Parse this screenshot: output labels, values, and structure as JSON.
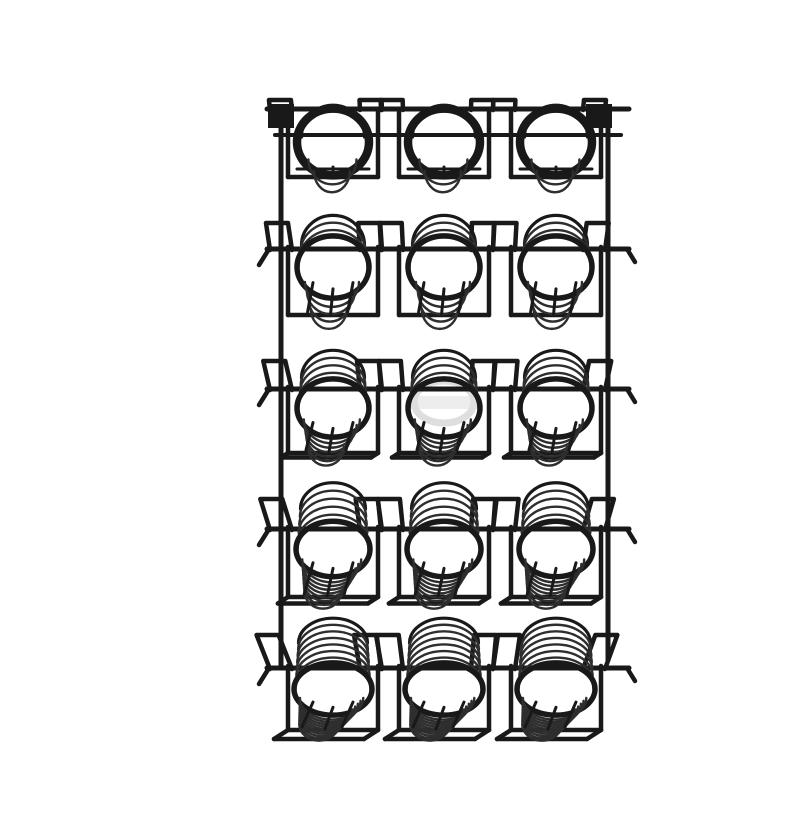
{
  "image": {
    "description": "Black wire wall-mount display rack with five shelves, each shelf holding three cylindrical coiled-wire holders in square brackets, photographed on a plain white background",
    "background_color": "#ffffff",
    "wire_color": "#191919",
    "thin_wire_color": "#2e2e2e"
  },
  "rack": {
    "canvas": {
      "width": 800,
      "height": 800
    },
    "rails": {
      "left_x": 241,
      "right_x": 568,
      "top_y": 92,
      "bottom_y": 652
    },
    "bar_x1": 227,
    "bar_x2": 589,
    "basket_centers_x": [
      293,
      404,
      516
    ],
    "bracket_half_width": 45,
    "loop_offsets": [
      -52,
      38
    ],
    "loop_half_width": 11,
    "mount_plate": {
      "left_x": 228,
      "right_x": 546,
      "y": 88,
      "size": 26
    },
    "stroke": {
      "rail": 5,
      "bar": 5,
      "loop": 4.5,
      "bracket": 4.5,
      "rim": 5.5,
      "rim_tier1": 8.5,
      "coil": 2.4,
      "back_rim": 3.2,
      "strut": 3
    },
    "watermark": {
      "cx": 404,
      "cy": 386,
      "color": "#dedede"
    },
    "tiers": [
      {
        "bar_y": 93,
        "bar2_y": 119,
        "center_y": 126,
        "radius": 36,
        "base_y": 161,
        "tilt": 0.08,
        "loop_height": 9,
        "coil_lift": 5,
        "coils_top": 2,
        "coils_inner": 2,
        "has_plates": true
      },
      {
        "bar_y": 233,
        "center_y": 251,
        "radius": 36,
        "base_y": 299,
        "tilt": 0.3,
        "loop_height": 26,
        "coil_lift": 22,
        "coils_top": 4,
        "coils_inner": 4
      },
      {
        "bar_y": 373,
        "center_y": 392,
        "radius": 36,
        "base_y": 437,
        "tilt": 0.5,
        "loop_height": 28,
        "coil_lift": 30,
        "coils_top": 5,
        "coils_inner": 6
      },
      {
        "bar_y": 513,
        "center_y": 533,
        "radius": 37,
        "base_y": 581,
        "tilt": 0.72,
        "loop_height": 30,
        "coil_lift": 40,
        "coils_top": 6,
        "coils_inner": 8
      },
      {
        "bar_y": 652,
        "center_y": 673,
        "radius": 39,
        "base_y": 714,
        "tilt": 1.0,
        "loop_height": 33,
        "coil_lift": 46,
        "coils_top": 8,
        "coils_inner": 10
      }
    ]
  }
}
